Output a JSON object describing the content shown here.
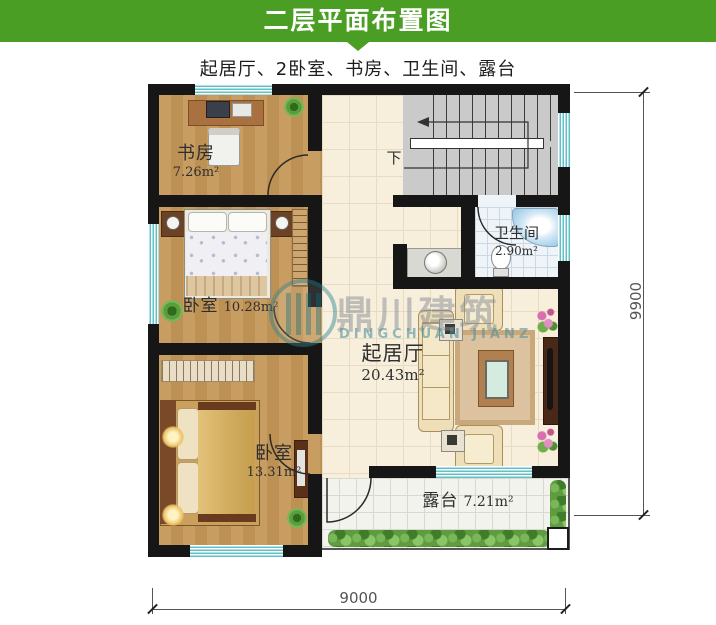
{
  "header": {
    "title": "二层平面布置图"
  },
  "subtitle": "起居厅、2卧室、书房、卫生间、露台",
  "rooms": {
    "study": {
      "name": "书房",
      "area": "7.26m²"
    },
    "bedroom1": {
      "name": "卧室",
      "area": "10.28m²"
    },
    "bedroom2": {
      "name": "卧室",
      "area": "13.31m²"
    },
    "living": {
      "name": "起居厅",
      "area": "20.43m²"
    },
    "bathroom": {
      "name": "卫生间",
      "area": "2.90m²"
    },
    "terrace": {
      "name": "露台",
      "area": "7.21m²"
    }
  },
  "stairs": {
    "direction_label": "下"
  },
  "dimensions": {
    "width_mm": "9000",
    "height_mm": "9900"
  },
  "watermark": {
    "name_cn": "鼎川建筑",
    "name_en": "DINGCHUAN JIANZ"
  },
  "colors": {
    "header_green": "#4a9e23",
    "wall": "#161616",
    "window_teal": "#5ec1c9",
    "wood": "#c2955a"
  }
}
